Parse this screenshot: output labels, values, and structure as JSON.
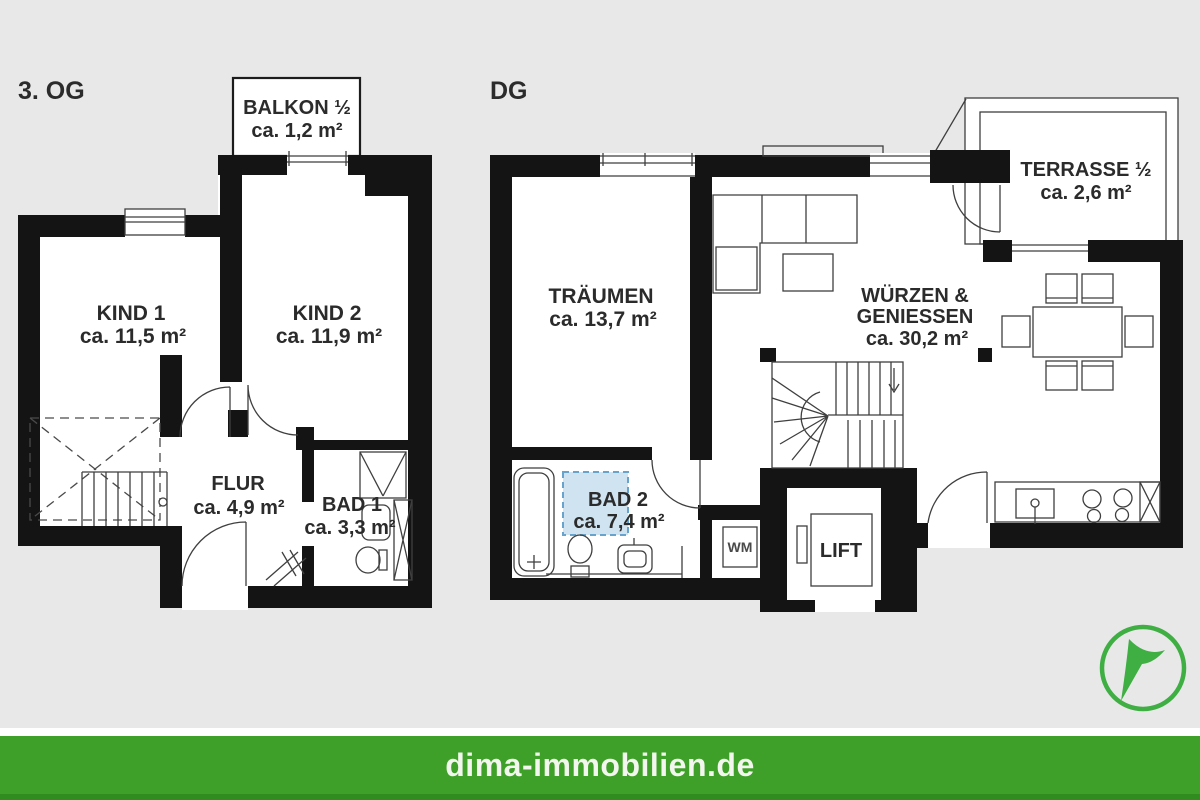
{
  "colors": {
    "bg": "#e8e8e8",
    "plan": "#ffffff",
    "wall": "#141414",
    "line": "#3f3f3f",
    "text": "#2b2b2b",
    "green": "#3ea028",
    "green_dark": "#318c20",
    "footer_text": "#f3f6ee",
    "logo_green": "#3fae43",
    "skylight_fill": "#cfe3f1",
    "skylight_border": "#67a3cc"
  },
  "floors": [
    {
      "label": "3. OG",
      "rooms": {
        "balkon": {
          "name": "BALKON ½",
          "area": "ca. 1,2 m²"
        },
        "kind1": {
          "name": "KIND 1",
          "area": "ca. 11,5 m²"
        },
        "kind2": {
          "name": "KIND 2",
          "area": "ca. 11,9 m²"
        },
        "flur": {
          "name": "FLUR",
          "area": "ca. 4,9 m²"
        },
        "bad1": {
          "name": "BAD 1",
          "area": "ca. 3,3 m²"
        }
      }
    },
    {
      "label": "DG",
      "rooms": {
        "traeumen": {
          "name": "TRÄUMEN",
          "area": "ca. 13,7 m²"
        },
        "wuerzen": {
          "name_line1": "WÜRZEN &",
          "name_line2": "GENIESSEN",
          "area": "ca. 30,2 m²"
        },
        "terrasse": {
          "name": "TERRASSE ½",
          "area": "ca. 2,6 m²"
        },
        "bad2": {
          "name": "BAD 2",
          "area": "ca. 7,4 m²"
        },
        "lift": {
          "name": "LIFT"
        },
        "wm": {
          "name": "WM"
        }
      }
    }
  ],
  "footer": {
    "website": "dima-immobilien.de"
  }
}
